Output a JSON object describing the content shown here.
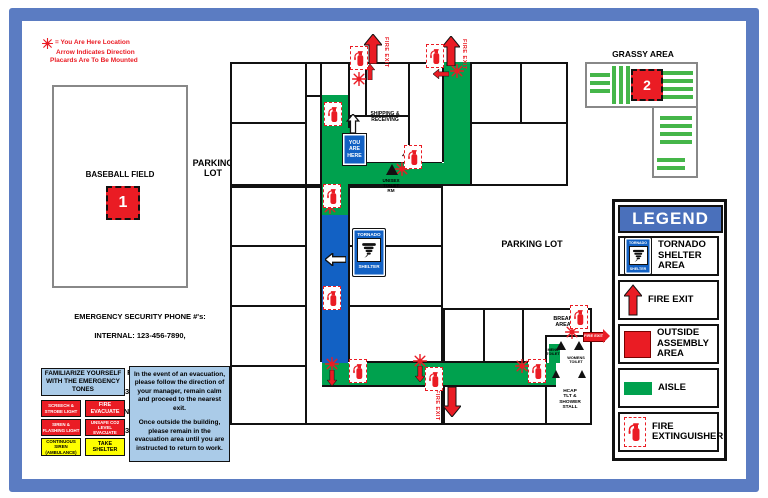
{
  "note": {
    "symbol_meaning": "= You Are Here Location",
    "line2": "Arrow Indicates Direction",
    "line3": "Placards Are To Be Mounted"
  },
  "labels": {
    "baseball_field": "BASEBALL FIELD",
    "marker_1": "1",
    "parking_lot_left": "PARKING\nLOT",
    "parking_lot_right": "PARKING LOT",
    "grassy_area": "GRASSY AREA",
    "marker_2": "2",
    "shipping_receiving": "SHIPPING &\nRECEIVING",
    "you_are_here": "YOU\nARE\nHERE",
    "unisex_toilet": "UNISEX\nTOILET\nRM",
    "tornado": "TORNADO",
    "shelter": "SHELTER",
    "break_area": "BREAK\nAREA",
    "mens_toilet": "MENS\nTOILET",
    "womens_toilet": "WOMENS\nTOILET",
    "hcap_tlt": "HCAP\nTLT &\nSHOWER\nSTALL",
    "fire_exit": "FIRE EXIT"
  },
  "phones": {
    "title": "EMERGENCY SECURITY PHONE #'s:",
    "internal": "INTERNAL: 123-456-7890,",
    "external_header": "EXTERNAL:  FIRE DEPARTMENT",
    "fire_dept_number": "123-456-7890",
    "sheriff": "COUNTY SHERIFF",
    "sheriff_number": "123-456-7890"
  },
  "tones": {
    "header": "FAMILIARIZE YOURSELF WITH THE EMERGENCY TONES",
    "rows": [
      {
        "left": "SCREECH & STROBE LIGHT",
        "right": "FIRE EVACUATE",
        "style": "red"
      },
      {
        "left": "SIREN & FLASHING LIGHT",
        "right": "UNSAFE CO2 LEVEL EVACUATE",
        "style": "red"
      },
      {
        "left": "CONTINUOUS SIREN (AMBULANCE)",
        "right": "TAKE SHELTER",
        "style": "yellow"
      }
    ]
  },
  "evacuation": {
    "para1": "In the event of an evacuation, please follow the direction of your manager, remain calm and proceed to the nearest exit.",
    "para2": "Once outside the building, please remain in the evacuation area until you are instructed to return to work."
  },
  "legend": {
    "title": "LEGEND",
    "items": [
      {
        "label": "TORNADO SHELTER AREA"
      },
      {
        "label": "FIRE EXIT"
      },
      {
        "label": "OUTSIDE ASSEMBLY AREA"
      },
      {
        "label": "AISLE"
      },
      {
        "label": "FIRE EXTINGUISHER"
      }
    ]
  },
  "colors": {
    "frame_blue": "#5b7cc2",
    "aisle_green": "#00a14e",
    "grass_stripe_green": "#45b649",
    "shelter_blue": "#1261c4",
    "alert_red": "#ea1c24",
    "legend_header_blue": "#4a70bb",
    "info_panel_blue": "#aacbe8",
    "tone_yellow": "#feff00",
    "wall_black": "#111111"
  },
  "icons": {
    "you_are_here_marker": "starburst-icon",
    "fire_extinguisher": "fire-extinguisher-icon",
    "fire_exit_arrow": "arrow-up-icon",
    "tornado_shelter": "tornado-icon",
    "direction_arrow": "arrow-icon"
  }
}
